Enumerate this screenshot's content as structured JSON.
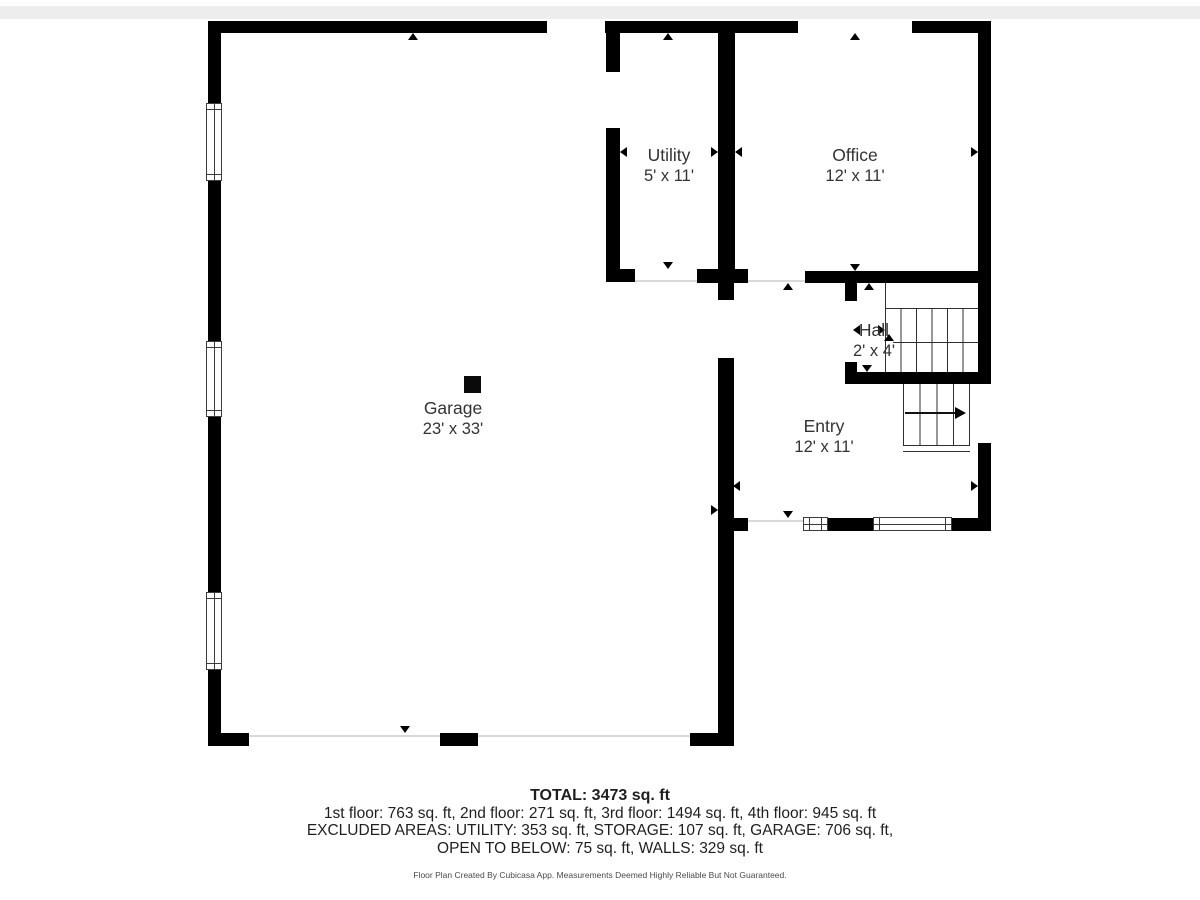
{
  "plan": {
    "rooms": [
      {
        "name": "Utility",
        "dims": "5' x 11'"
      },
      {
        "name": "Office",
        "dims": "12' x 11'"
      },
      {
        "name": "Garage",
        "dims": "23' x 33'"
      },
      {
        "name": "Hall",
        "dims": "2' x 4'"
      },
      {
        "name": "Entry",
        "dims": "12' x 11'"
      }
    ]
  },
  "summary": {
    "total": "TOTAL: 3473 sq. ft",
    "floors": "1st floor: 763 sq. ft, 2nd floor: 271 sq. ft, 3rd floor: 1494 sq. ft, 4th floor: 945 sq. ft",
    "excluded_line1": "EXCLUDED AREAS: UTILITY: 353 sq. ft, STORAGE: 107 sq. ft, GARAGE: 706 sq. ft,",
    "excluded_line2": "OPEN TO BELOW: 75 sq. ft, WALLS: 329 sq. ft",
    "footer": "Floor Plan Created By Cubicasa App. Measurements Deemed Highly Reliable But Not Guaranteed."
  },
  "colors": {
    "wall": "#000000",
    "room_text": "#333333",
    "opening_line": "#d9d9d9",
    "top_band": "#ededed"
  }
}
